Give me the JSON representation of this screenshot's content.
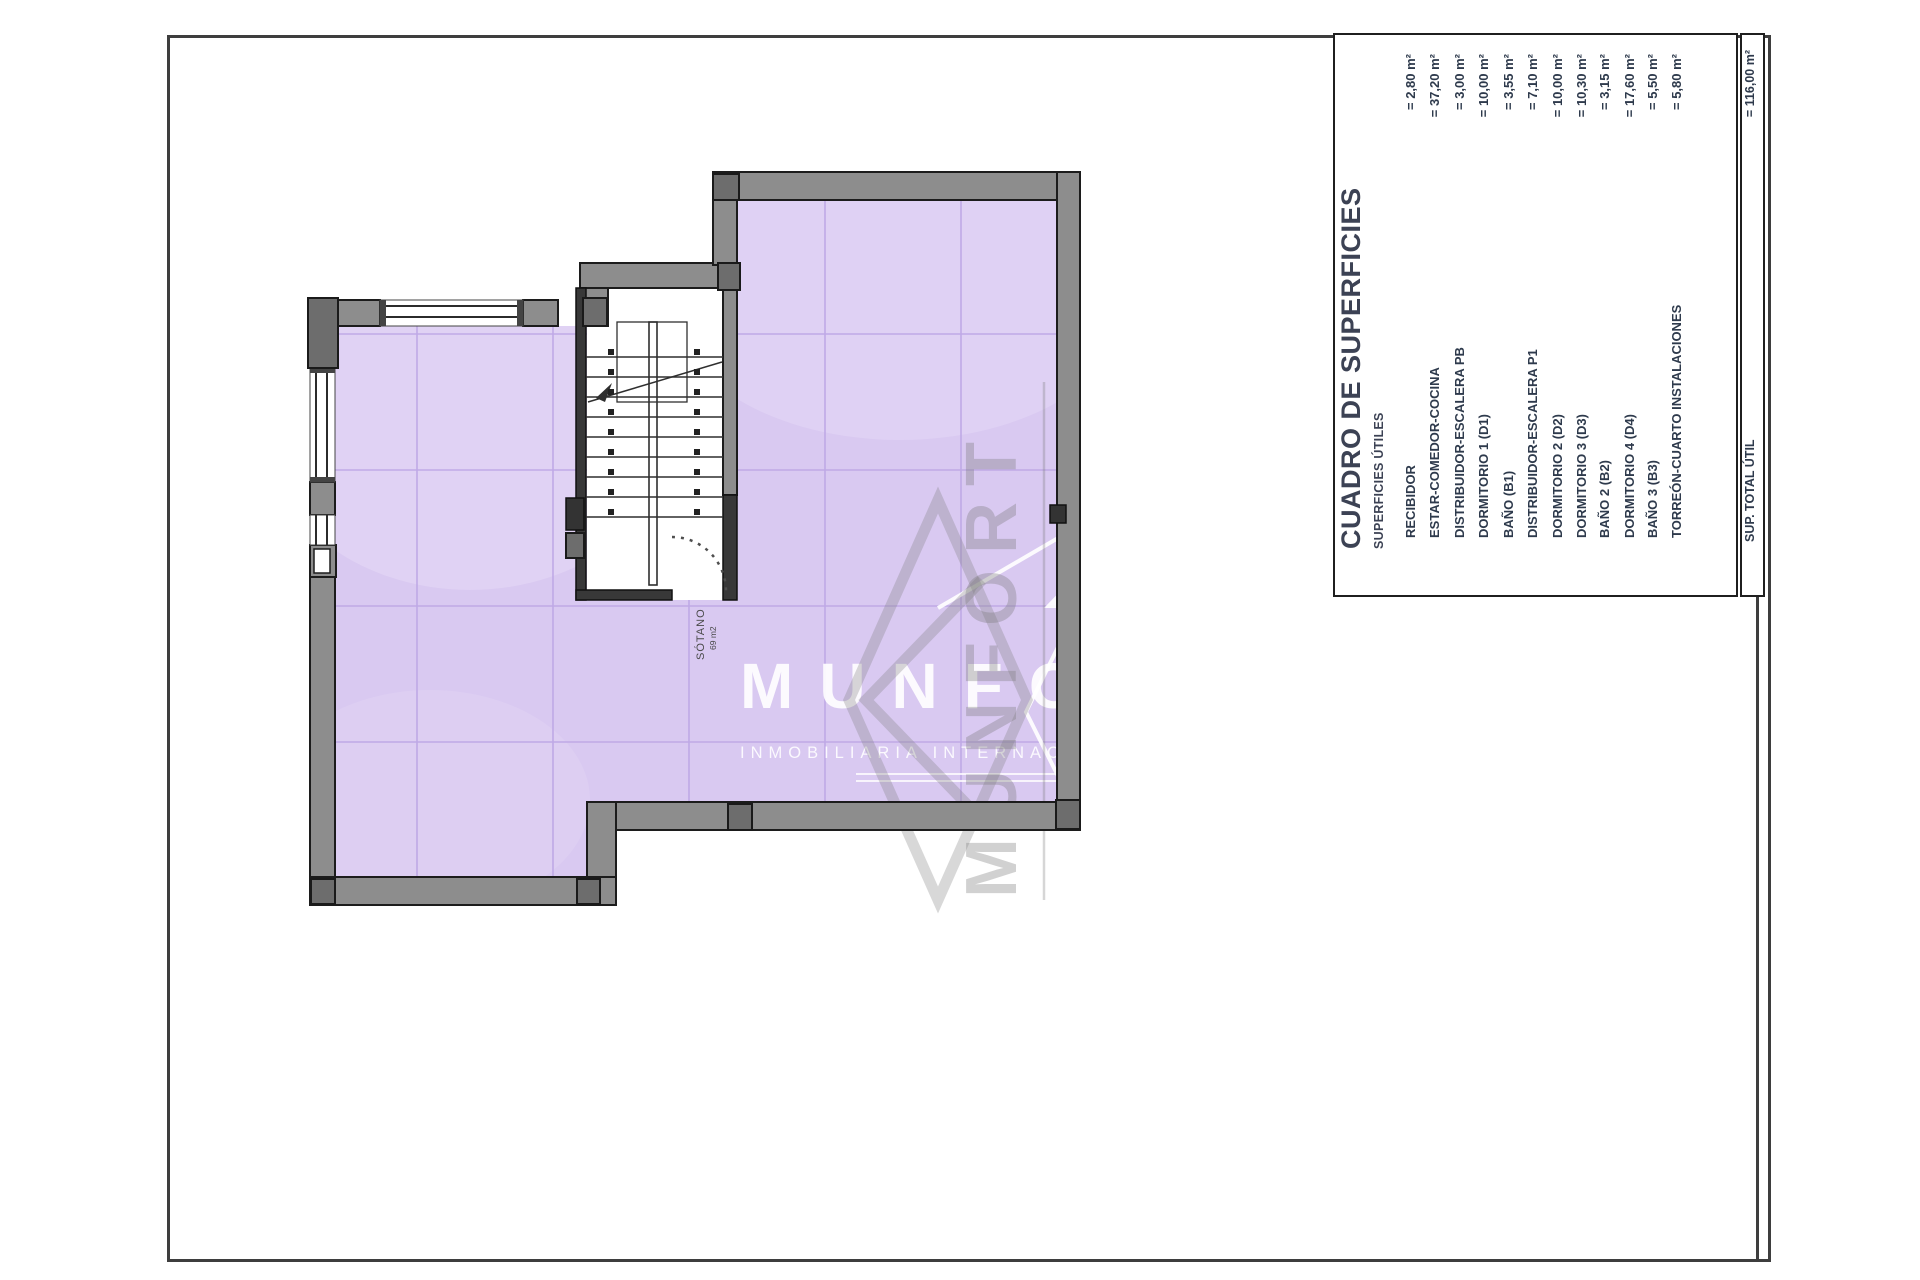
{
  "table": {
    "title": "CUADRO DE SUPERFICIES",
    "subtitle": "SUPERFICIES ÚTILES",
    "rows": [
      {
        "label": "RECIBIDOR",
        "value": "= 2,80 m²"
      },
      {
        "label": "ESTAR-COMEDOR-COCINA",
        "value": "= 37,20 m²"
      },
      {
        "label": "DISTRIBUIDOR-ESCALERA PB",
        "value": "= 3,00 m²"
      },
      {
        "label": "DORMITORIO 1 (D1)",
        "value": "= 10,00 m²"
      },
      {
        "label": "BAÑO (B1)",
        "value": "= 3,55 m²"
      },
      {
        "label": "DISTRIBUIDOR-ESCALERA P1",
        "value": "= 7,10 m²"
      },
      {
        "label": "DORMITORIO 2 (D2)",
        "value": "= 10,00 m²"
      },
      {
        "label": "DORMITORIO 3 (D3)",
        "value": "= 10,30 m²"
      },
      {
        "label": "BAÑO 2 (B2)",
        "value": "= 3,15 m²"
      },
      {
        "label": "DORMITORIO 4 (D4)",
        "value": "= 17,60 m²"
      },
      {
        "label": "BAÑO 3 (B3)",
        "value": "= 5,50 m²"
      },
      {
        "label": "TORREÓN-CUARTO INSTALACIONES",
        "value": "= 5,80 m²"
      }
    ],
    "total": {
      "label": "SUP. TOTAL ÚTIL",
      "value": "= 116,00 m²"
    }
  },
  "plan": {
    "room_label": {
      "name": "SÓTANO",
      "area": "69 m2"
    }
  },
  "watermark": {
    "brand": "MUNFORT",
    "tagline": "INMOBILIARIA INTERNACIONAL"
  },
  "colors": {
    "floor_fill": "#d9c9f1",
    "floor_grid": "#bfa9e6",
    "wall_gray": "#8d8d8d",
    "pilaster_gray": "#6d6d6d",
    "line_dark": "#1c1c1c",
    "table_text": "#2e3a4c",
    "title_text": "#3c4254"
  }
}
